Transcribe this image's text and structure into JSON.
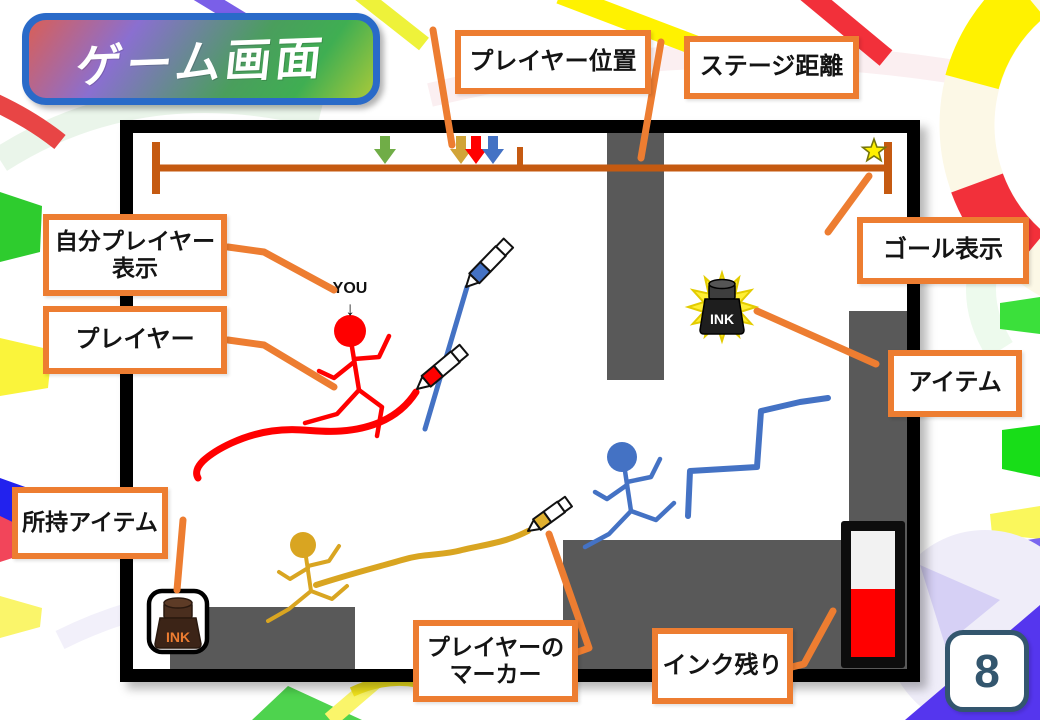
{
  "slide": {
    "title": "ゲーム画面",
    "page_number": "8"
  },
  "callouts": {
    "player_position": "プレイヤー位置",
    "stage_distance": "ステージ距離",
    "self_player_display": "自分プレイヤー\n表示",
    "player": "プレイヤー",
    "goal_display": "ゴール表示",
    "item": "アイテム",
    "held_item": "所持アイテム",
    "player_marker": "プレイヤーの\nマーカー",
    "ink_remaining": "インク残り"
  },
  "game_screen": {
    "you_indicator_label": "YOU",
    "you_indicator_arrow": "↓",
    "item_ink_label": "INK",
    "held_item_ink_label": "INK",
    "position_bar_markers": [
      "green",
      "gold",
      "red",
      "blue"
    ],
    "goal_icon": "star",
    "ink_gauge_fill_ratio": 0.55
  },
  "colors": {
    "callout_border_orange": "#ED7D31",
    "position_bar_brown": "#C55A11",
    "platform_gray": "#595959",
    "player_red": "#FF0000",
    "player_blue": "#4472C4",
    "player_gold": "#D9A521",
    "marker_green": "#70AD47",
    "goal_star_yellow": "#FFF000",
    "ink_gauge_red": "#FF0000",
    "page_number_navy": "#33566E",
    "title_border_blue": "#2A6AC8"
  }
}
